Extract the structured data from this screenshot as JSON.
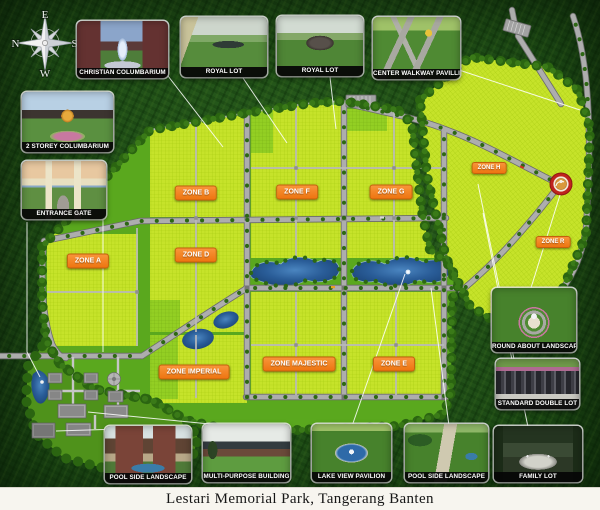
{
  "title_bar": {
    "text": "Lestari Memorial Park,  Tangerang Banten"
  },
  "compass": {
    "top": "E",
    "right": "S",
    "bottom": "W",
    "left": "N"
  },
  "zones": [
    {
      "id": "zone-a",
      "label": "ZONE A"
    },
    {
      "id": "zone-b",
      "label": "ZONE B"
    },
    {
      "id": "zone-d",
      "label": "ZONE D"
    },
    {
      "id": "zone-f",
      "label": "ZONE F"
    },
    {
      "id": "zone-g",
      "label": "ZONE G"
    },
    {
      "id": "zone-h",
      "label": "ZONE H"
    },
    {
      "id": "zone-r",
      "label": "ZONE R"
    },
    {
      "id": "zone-imperial",
      "label": "ZONE IMPERIAL"
    },
    {
      "id": "zone-majestic",
      "label": "ZONE MAJESTIC"
    },
    {
      "id": "zone-e",
      "label": "ZONE E"
    }
  ],
  "cards": [
    {
      "id": "christian-columbarium",
      "label": "CHRISTIAN COLUMBARIUM"
    },
    {
      "id": "royal-lot-1",
      "label": "ROYAL LOT"
    },
    {
      "id": "royal-lot-2",
      "label": "ROYAL LOT"
    },
    {
      "id": "center-walkway-pavilion",
      "label": "CENTER WALKWAY PAVILLION"
    },
    {
      "id": "two-storey-columbarium",
      "label": "2 STOREY COLUMBARIUM"
    },
    {
      "id": "entrance-gate",
      "label": "ENTRANCE GATE"
    },
    {
      "id": "round-about-landscaping",
      "label": "ROUND ABOUT LANDSCAPING"
    },
    {
      "id": "standard-double-lot",
      "label": "STANDARD DOUBLE LOT"
    },
    {
      "id": "family-lot",
      "label": "FAMILY LOT"
    },
    {
      "id": "pool-side-landscape-left",
      "label": "POOL SIDE LANDSCAPE"
    },
    {
      "id": "multi-purpose-building",
      "label": "MULTI-PURPOSE BUILDING"
    },
    {
      "id": "lake-view-pavilion",
      "label": "LAKE VIEW PAVILION"
    },
    {
      "id": "pool-side-landscape-right",
      "label": "POOL SIDE LANDSCAPE"
    }
  ],
  "colors": {
    "badge_orange": "#EE7511",
    "road_gray": "#ADADAD",
    "park_green": "#5AA81E",
    "plot_lime": "#C6E32A",
    "lake_blue": "#2A5D98",
    "forest_green": "#1D4A15",
    "roundabout_red": "#C0261F",
    "leader_line": "#FFFFFF",
    "card_label_bg": "#060606",
    "title_strip": "#F7F5EF"
  }
}
